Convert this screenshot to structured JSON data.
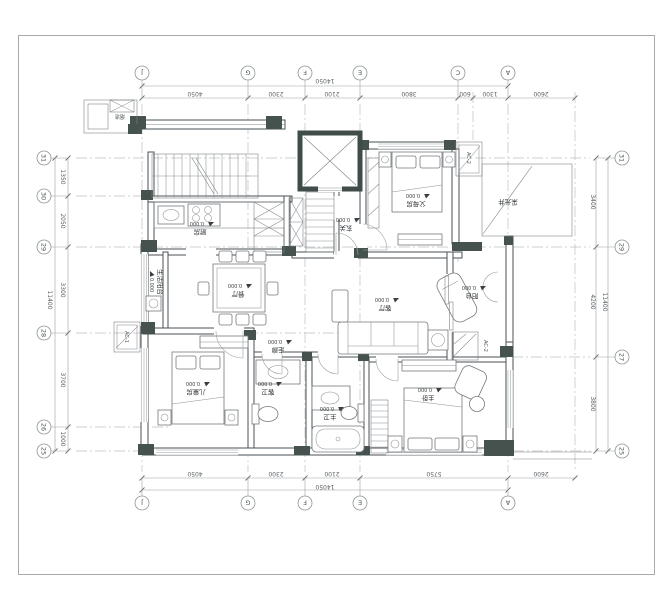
{
  "colors": {
    "column_fill": "#45524e",
    "wall_line": "#4b5054",
    "grid_line": "#bcc0c2",
    "paper": "#ffffff"
  },
  "grid_bubbles": {
    "top": [
      "J",
      "G",
      "F",
      "E",
      "C",
      "A"
    ],
    "bottom": [
      "J",
      "G",
      "F",
      "E",
      "A"
    ],
    "left": [
      "31",
      "30",
      "29",
      "28",
      "26",
      "25"
    ],
    "right": [
      "31",
      "29",
      "27",
      "25"
    ]
  },
  "dimensions": {
    "top_total": "14050",
    "top_segments": [
      "4050",
      "2300",
      "2100",
      "3800",
      "600",
      "1300",
      "2600"
    ],
    "bottom_total": "14050",
    "bottom_segments": [
      "4050",
      "2300",
      "2100",
      "5750",
      "2600"
    ],
    "left_total": "11400",
    "left_segments": [
      "1350",
      "2050",
      "3300",
      "3700",
      "1000"
    ],
    "right_total": "11400",
    "right_segments": [
      "3400",
      "4200",
      "3800"
    ]
  },
  "rooms": {
    "kitchen": {
      "name": "厨房",
      "elev": "0.000"
    },
    "foyer": {
      "name": "玄关",
      "elev": "0.000"
    },
    "parents_room": {
      "name": "父母房",
      "elev": "0.000"
    },
    "living_room": {
      "name": "客厅",
      "elev": "0.000"
    },
    "dining_room": {
      "name": "餐厅",
      "elev": "0.000"
    },
    "service_balcony": {
      "name": "生活阳台",
      "elev": "0.000"
    },
    "children_room": {
      "name": "儿童房",
      "elev": "0.000"
    },
    "corridor": {
      "name": "走廊",
      "elev": "0.000"
    },
    "guest_bath": {
      "name": "客卫",
      "elev": "0.000"
    },
    "master_bath": {
      "name": "主卫",
      "elev": "0.000"
    },
    "master_bedroom": {
      "name": "主卧",
      "elev": "0.000"
    },
    "balcony": {
      "name": "阳台",
      "elev": "0.000"
    },
    "light_well": {
      "name": "采光井"
    },
    "flue": {
      "name": "烟道"
    }
  },
  "equipment": {
    "ac1": "AC-1",
    "ac2_top": "AC-2",
    "ac2_right": "AC-2"
  }
}
